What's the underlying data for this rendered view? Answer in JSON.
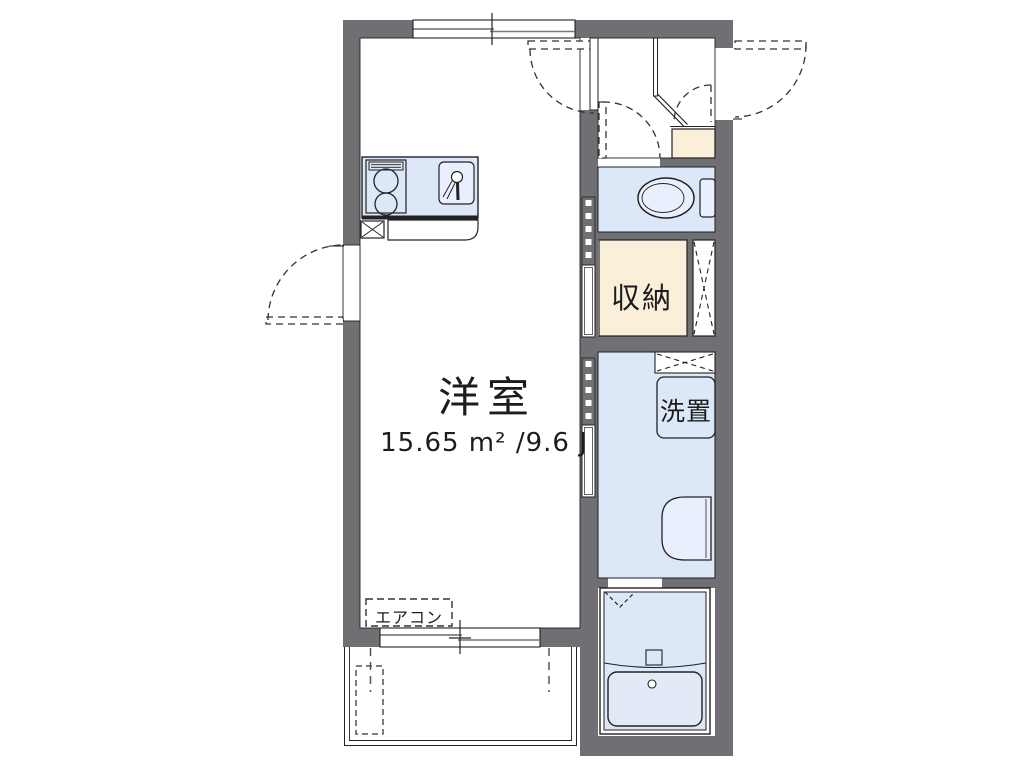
{
  "floorplan": {
    "room": {
      "name": "洋室",
      "area": "15.65 m² /9.6 J"
    },
    "labels": {
      "closet": "収納",
      "washer_place": "洗置",
      "aircon": "エアコン"
    },
    "colors": {
      "wall": "#6f6f74",
      "water_room": "#dce7f7",
      "storage": "#faf0da",
      "fixture": "#e9effc",
      "line": "#1f1f1f",
      "background": "#ffffff"
    }
  }
}
